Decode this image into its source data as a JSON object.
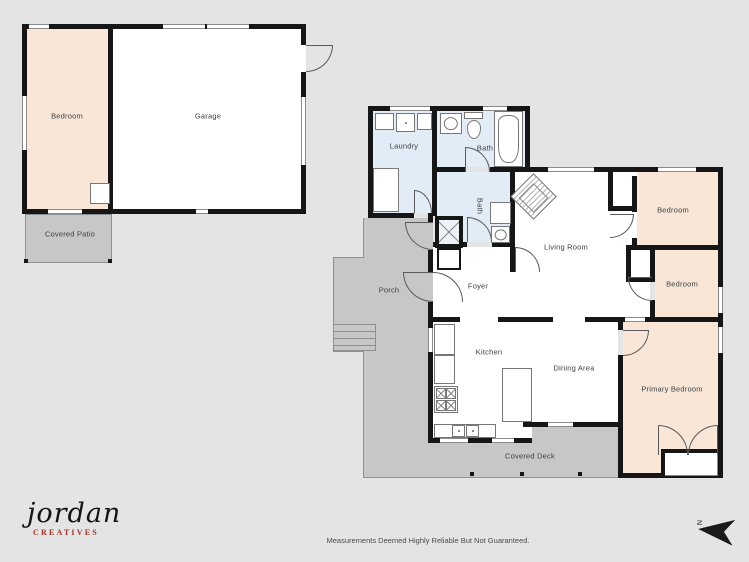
{
  "colors": {
    "bg": "#e4e4e4",
    "wall": "#161616",
    "bedroom": "#f9e6d7",
    "wet": "#e2ecf6",
    "outdoor": "#c7c7c7",
    "room": "#ffffff",
    "accent": "#a93226",
    "ink": "#3b4046"
  },
  "rooms": {
    "bedroom_a": "Bedroom",
    "garage": "Garage",
    "covered_patio": "Covered Patio",
    "laundry": "Laundry",
    "bath1": "Bath",
    "bath2": "Bath",
    "living": "Living Room",
    "foyer": "Foyer",
    "porch": "Porch",
    "kitchen": "Kitchen",
    "dining": "Dining Area",
    "bedroom1": "Bedroom",
    "bedroom2": "Bedroom",
    "primary": "Primary Bedroom",
    "deck": "Covered Deck"
  },
  "branding": {
    "logo_script": "jordan",
    "logo_sub": "CREATIVES"
  },
  "footer": {
    "disclaimer": "Measurements Deemed Highly Reliable But Not Guaranteed."
  },
  "compass": {
    "label": "N"
  }
}
